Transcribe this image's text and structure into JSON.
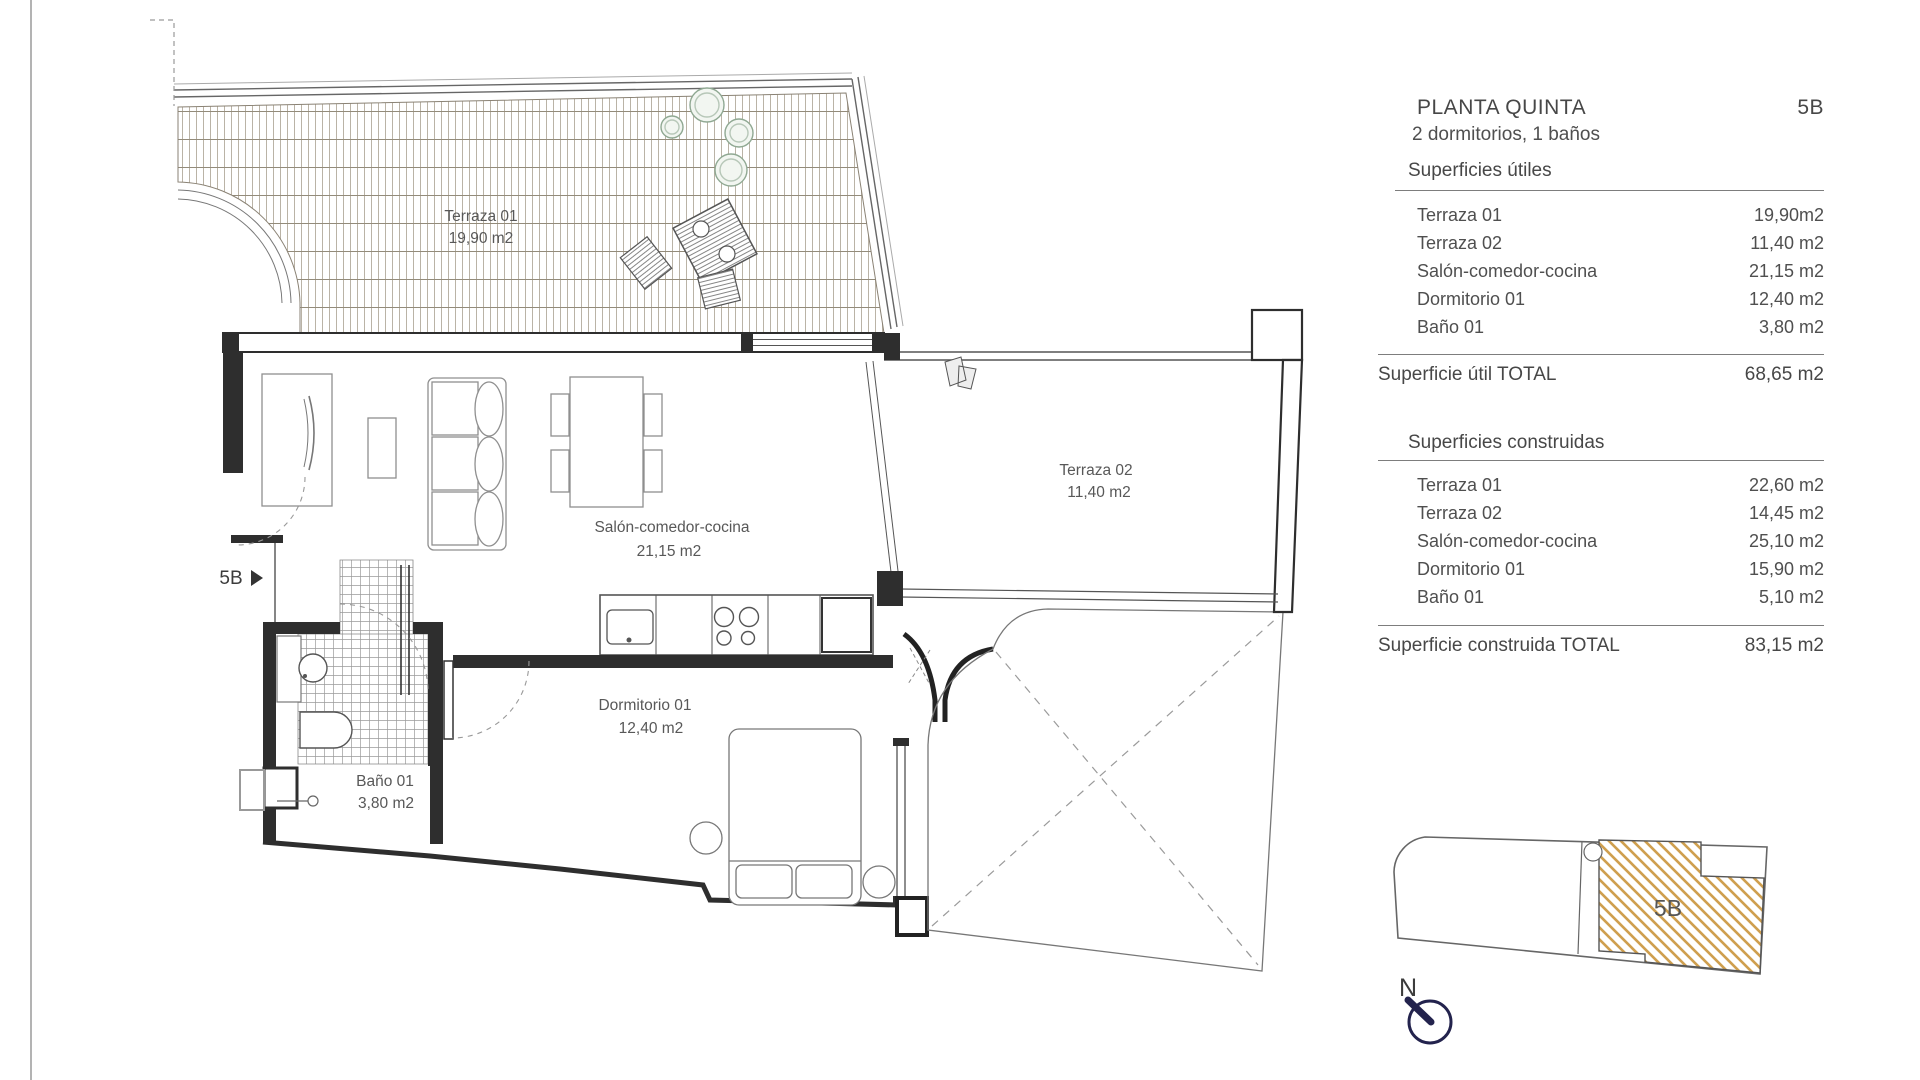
{
  "panel": {
    "title": "PLANTA QUINTA",
    "unit": "5B",
    "subtitle": "2 dormitorios, 1 baños",
    "useful": {
      "heading": "Superficies útiles",
      "rows": [
        {
          "label": "Terraza 01",
          "value": "19,90m2"
        },
        {
          "label": "Terraza 02",
          "value": "11,40 m2"
        },
        {
          "label": "Salón-comedor-cocina",
          "value": "21,15 m2"
        },
        {
          "label": "Dormitorio 01",
          "value": "12,40 m2"
        },
        {
          "label": "Baño 01",
          "value": "3,80 m2"
        }
      ],
      "total_label": "Superficie útil TOTAL",
      "total_value": "68,65 m2"
    },
    "built": {
      "heading": "Superficies  construidas",
      "rows": [
        {
          "label": "Terraza 01",
          "value": "22,60 m2"
        },
        {
          "label": "Terraza 02",
          "value": "14,45 m2"
        },
        {
          "label": "Salón-comedor-cocina",
          "value": "25,10 m2"
        },
        {
          "label": "Dormitorio 01",
          "value": "15,90 m2"
        },
        {
          "label": "Baño 01",
          "value": "5,10 m2"
        }
      ],
      "total_label": "Superficie construida TOTAL",
      "total_value": "83,15 m2"
    }
  },
  "plan": {
    "entry_label": "5B",
    "rooms": {
      "terraza01": {
        "name": "Terraza 01",
        "area": "19,90 m2"
      },
      "terraza02": {
        "name": "Terraza 02",
        "area": "11,40 m2"
      },
      "salon": {
        "name": "Salón-comedor-cocina",
        "area": "21,15 m2"
      },
      "dormitorio": {
        "name": "Dormitorio 01",
        "area": "12,40 m2"
      },
      "bano": {
        "name": "Baño 01",
        "area": "3,80 m2"
      }
    }
  },
  "keyplan": {
    "unit_label": "5B",
    "north_label": "N"
  },
  "colors": {
    "wall": "#2e2e2e",
    "deck_hatch": "#b3ab9c",
    "deck_course": "#938b7a",
    "tile_line": "#999999",
    "plant": "#8fa892",
    "keyplan_hatch": "#cf9f4f",
    "north": "#23234d",
    "text": "#4f4f4f"
  }
}
